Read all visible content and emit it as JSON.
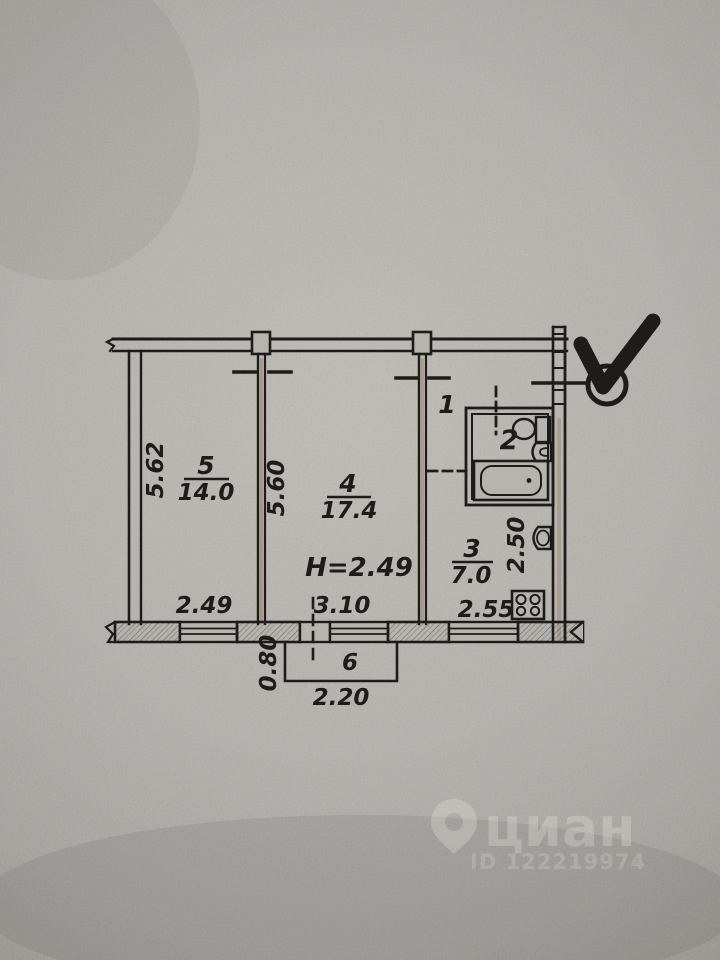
{
  "plan": {
    "height_note": "H=2.49",
    "rooms": {
      "room5": {
        "number": "5",
        "area": "14.0"
      },
      "room4": {
        "number": "4",
        "area": "17.4"
      },
      "room3": {
        "number": "3",
        "area": "7.0"
      },
      "hall": {
        "number": "1"
      },
      "bath": {
        "number": "2"
      },
      "balcony": {
        "number": "6"
      }
    },
    "dims": {
      "room5_height": "5.62",
      "room4_height": "5.60",
      "room5_width": "2.49",
      "room4_width": "3.10",
      "kitchen_width": "2.55",
      "kitchen_height": "2.50",
      "balcony_depth": "0.80",
      "balcony_width": "2.20"
    },
    "colors": {
      "ink": "#1d1c1a",
      "rust": "#8a4a22",
      "paper": "#b6b4ae"
    }
  },
  "watermark": {
    "brand": "циан",
    "id_label": "ID 122219974"
  }
}
